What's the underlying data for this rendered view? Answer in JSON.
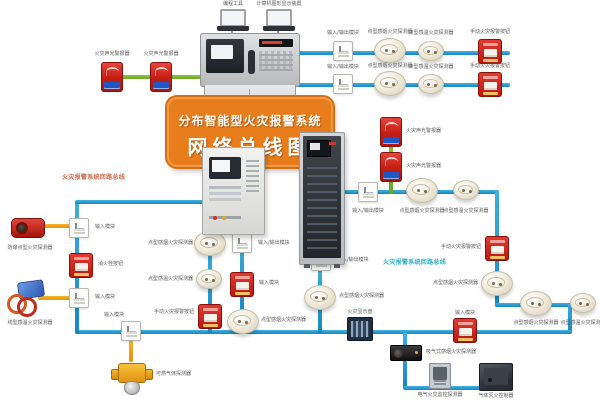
{
  "banner": {
    "line1": "分布智能型火灾报警系统",
    "line2": "网络总线图"
  },
  "loop_labels": {
    "left": "火灾报警系统回路总线",
    "right": "火灾报警系统回路总线"
  },
  "colors": {
    "bus_blue": "#1b9ad2",
    "branch_green": "#7ab82e",
    "branch_yellow": "#f0a11c",
    "banner_orange": "#e87d1c",
    "device_red": "#c61f18",
    "loop_text_cyan": "#2fb3c6",
    "loop_text_orange": "#cf6a4a"
  },
  "nodes": [
    {
      "n": "sound-light-alarm-1",
      "t": "alarm",
      "x": 112,
      "y": 77,
      "l": "火灾声光警报器",
      "la": "c",
      "lx": 112,
      "ly": 52
    },
    {
      "n": "sound-light-alarm-2",
      "t": "alarm",
      "x": 161,
      "y": 77,
      "l": "火灾声光警报器",
      "la": "c",
      "lx": 161,
      "ly": 52
    },
    {
      "n": "programming-laptop",
      "t": "laptop",
      "x": 233,
      "y": 19,
      "l": "编程工具",
      "la": "c",
      "lx": 233,
      "ly": 2
    },
    {
      "n": "graphics-display-laptop",
      "t": "laptop",
      "x": 279,
      "y": 19,
      "l": "计算机图形显示装置",
      "la": "c",
      "lx": 279,
      "ly": 2
    },
    {
      "n": "io-module-row1",
      "t": "module",
      "x": 343,
      "y": 51,
      "l": "输入/输出模块",
      "la": "c",
      "lx": 343,
      "ly": 31
    },
    {
      "n": "smoke-detector-row1",
      "t": "smoke",
      "x": 390,
      "y": 50,
      "l": "点型感烟火灾探测器",
      "la": "c",
      "lx": 390,
      "ly": 30
    },
    {
      "n": "heat-detector-row1",
      "t": "heat",
      "x": 431,
      "y": 51,
      "l": "点型感温火灾探测器",
      "la": "c",
      "lx": 431,
      "ly": 31
    },
    {
      "n": "manual-call-point-row1",
      "t": "callpoint",
      "x": 490,
      "y": 51,
      "l": "手动火灾报警按钮",
      "la": "c",
      "lx": 490,
      "ly": 30
    },
    {
      "n": "io-module-row2",
      "t": "module",
      "x": 343,
      "y": 84,
      "l": "输入/输出模块",
      "la": "c",
      "lx": 343,
      "ly": 65
    },
    {
      "n": "smoke-detector-row2",
      "t": "smoke",
      "x": 390,
      "y": 83,
      "l": "点型感烟火灾探测器",
      "la": "c",
      "lx": 390,
      "ly": 64
    },
    {
      "n": "heat-detector-row2",
      "t": "heat",
      "x": 431,
      "y": 84,
      "l": "点型感温火灾探测器",
      "la": "c",
      "lx": 431,
      "ly": 65
    },
    {
      "n": "manual-call-point-row2",
      "t": "callpoint",
      "x": 490,
      "y": 84,
      "l": "手动火灾报警按钮",
      "la": "c",
      "lx": 490,
      "ly": 64
    },
    {
      "n": "sound-light-alarm-3",
      "t": "alarm",
      "x": 391,
      "y": 132,
      "l": "火灾声光警报器",
      "la": "l",
      "lx": 406,
      "ly": 129
    },
    {
      "n": "sound-light-alarm-4",
      "t": "alarm",
      "x": 391,
      "y": 167,
      "l": "火灾声光警报器",
      "la": "l",
      "lx": 406,
      "ly": 164
    },
    {
      "n": "io-module-bus-a",
      "t": "module",
      "x": 368,
      "y": 192,
      "l": "输入/输出模块",
      "la": "c",
      "lx": 368,
      "ly": 209
    },
    {
      "n": "smoke-detector-bus-a",
      "t": "smoke",
      "x": 422,
      "y": 190,
      "l": "点型感烟火灾探测器",
      "la": "c",
      "lx": 422,
      "ly": 209
    },
    {
      "n": "heat-detector-bus-a",
      "t": "heat",
      "x": 466,
      "y": 190,
      "l": "点型感温火灾探测器",
      "la": "c",
      "lx": 466,
      "ly": 209
    },
    {
      "n": "manual-call-point-right",
      "t": "callpoint",
      "x": 497,
      "y": 248,
      "l": "手动火灾报警按钮",
      "la": "r",
      "lx": 481,
      "ly": 245
    },
    {
      "n": "smoke-detector-right",
      "t": "smoke",
      "x": 497,
      "y": 283,
      "l": "点型感烟火灾探测器",
      "la": "r",
      "lx": 478,
      "ly": 281
    },
    {
      "n": "smoke-detector-bus-b",
      "t": "smoke",
      "x": 536,
      "y": 303,
      "l": "点型感烟火灾探测器",
      "la": "c",
      "lx": 536,
      "ly": 321
    },
    {
      "n": "heat-detector-bus-b",
      "t": "heat",
      "x": 583,
      "y": 303,
      "l": "点型感温火灾探测器",
      "la": "c",
      "lx": 583,
      "ly": 321
    },
    {
      "n": "smoke-detector-left-drop",
      "t": "smoke",
      "x": 210,
      "y": 243,
      "l": "点型感烟火灾探测器",
      "la": "r",
      "lx": 193,
      "ly": 241
    },
    {
      "n": "heat-detector-left-drop",
      "t": "heat",
      "x": 209,
      "y": 279,
      "l": "点型感温火灾探测器",
      "la": "r",
      "lx": 193,
      "ly": 277
    },
    {
      "n": "manual-call-point-left-drop",
      "t": "callpoint",
      "x": 210,
      "y": 316,
      "l": "手动火灾报警按钮",
      "la": "r",
      "lx": 194,
      "ly": 310
    },
    {
      "n": "io-module-right-drop",
      "t": "module",
      "x": 242,
      "y": 243,
      "l": "输入/输出模块",
      "la": "l",
      "lx": 258,
      "ly": 241
    },
    {
      "n": "input-module-right-drop",
      "t": "callpoint",
      "x": 242,
      "y": 284,
      "l": "输入模块",
      "la": "l",
      "lx": 259,
      "ly": 281
    },
    {
      "n": "smoke-detector-right-drop",
      "t": "smoke",
      "x": 243,
      "y": 321,
      "l": "点型感烟火灾探测器",
      "la": "l",
      "lx": 261,
      "ly": 318
    },
    {
      "n": "io-module-cabinet-drop",
      "t": "module",
      "x": 321,
      "y": 261,
      "l": "输入/输出模块",
      "la": "l",
      "lx": 337,
      "ly": 258
    },
    {
      "n": "smoke-detector-cabinet-drop",
      "t": "smoke",
      "x": 320,
      "y": 297,
      "l": "点型感烟火灾探测器",
      "la": "l",
      "lx": 339,
      "ly": 294
    },
    {
      "n": "fire-display-panel",
      "t": "slatted",
      "x": 360,
      "y": 329,
      "l": "火灾显示盘",
      "la": "c",
      "lx": 360,
      "ly": 310
    },
    {
      "n": "input-module-bottom",
      "t": "callpoint",
      "x": 465,
      "y": 330,
      "l": "输入模块",
      "la": "c",
      "lx": 465,
      "ly": 311
    },
    {
      "n": "aspirating-smoke-detector",
      "t": "aspirating",
      "x": 406,
      "y": 353,
      "l": "吸气式感烟火灾探测器",
      "la": "l",
      "lx": 426,
      "ly": 350
    },
    {
      "n": "electrical-fire-monitor",
      "t": "graypanel",
      "x": 440,
      "y": 376,
      "l": "电气火灾监控探测器",
      "la": "c",
      "lx": 440,
      "ly": 393
    },
    {
      "n": "gas-extinguishing-controller",
      "t": "darkbox",
      "x": 496,
      "y": 377,
      "l": "气体灭火控制器",
      "la": "c",
      "lx": 496,
      "ly": 394
    },
    {
      "n": "input-module-gas-branch",
      "t": "module",
      "x": 131,
      "y": 331,
      "l": "输入模块",
      "la": "c",
      "lx": 114,
      "ly": 313
    },
    {
      "n": "combustible-gas-detector",
      "t": "gas",
      "x": 131,
      "y": 375,
      "l": "可燃气体探测器",
      "la": "l",
      "lx": 156,
      "ly": 372
    },
    {
      "n": "explosion-proof-detector",
      "t": "explosion",
      "x": 28,
      "y": 226,
      "l": "防爆点型火灾探测器",
      "la": "c",
      "lx": 30,
      "ly": 246
    },
    {
      "n": "input-module-left-1",
      "t": "module",
      "x": 79,
      "y": 228,
      "l": "输入模块",
      "la": "l",
      "lx": 95,
      "ly": 225
    },
    {
      "n": "hydrant-button",
      "t": "callpoint",
      "x": 81,
      "y": 265,
      "l": "消火栓按钮",
      "la": "l",
      "lx": 98,
      "ly": 262
    },
    {
      "n": "input-module-left-2",
      "t": "module",
      "x": 79,
      "y": 298,
      "l": "输入模块",
      "la": "l",
      "lx": 95,
      "ly": 295
    },
    {
      "n": "linear-heat-detector",
      "t": "linear",
      "x": 26,
      "y": 298,
      "l": "线型感温火灾探测器",
      "la": "c",
      "lx": 30,
      "ly": 321
    }
  ]
}
